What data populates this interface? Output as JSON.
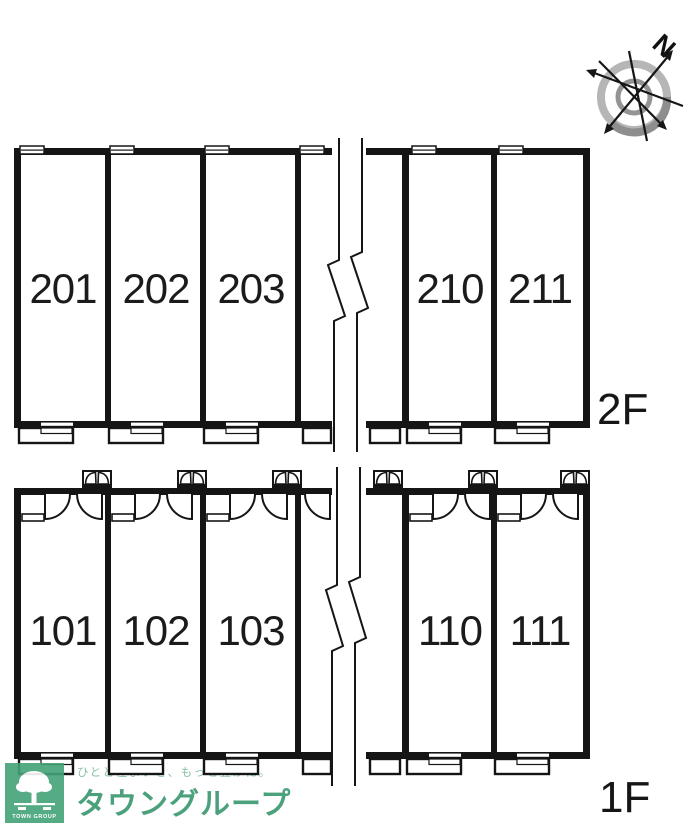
{
  "floors": [
    {
      "label": "2F",
      "rooms": [
        "201",
        "202",
        "203",
        "210",
        "211"
      ]
    },
    {
      "label": "1F",
      "rooms": [
        "101",
        "102",
        "103",
        "110",
        "111"
      ]
    }
  ],
  "compass": {
    "north_label": "N"
  },
  "branding": {
    "slogan": "ひとと住まいを、もっと豊かに。",
    "company": "タウングループ",
    "logo_text": "TOWN GROUP",
    "brand_green": "#42a377",
    "slogan_green": "#8cc3a6",
    "company_green": "#4ba17b"
  },
  "plan": {
    "line_color": "#151515"
  }
}
